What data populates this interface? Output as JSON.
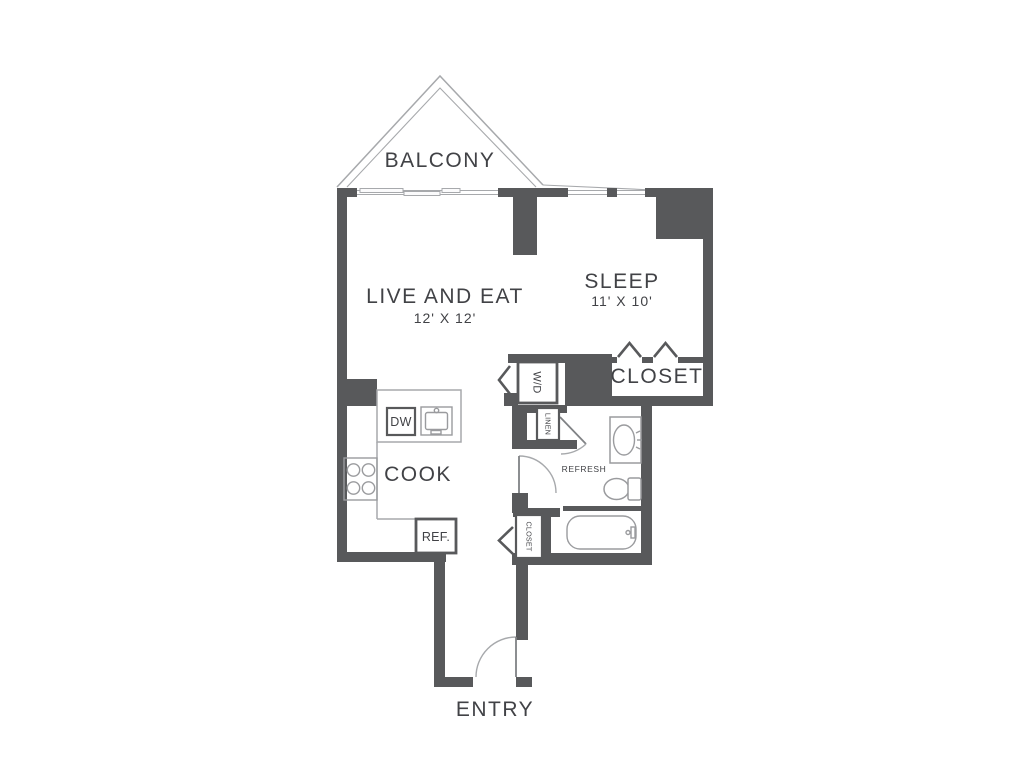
{
  "colors": {
    "wall": "#58595b",
    "line": "#a7a9ac",
    "line_mid": "#808285",
    "fixture": "#9a9b9e",
    "text": "#414246",
    "bg": "#ffffff"
  },
  "labels": {
    "balcony": "BALCONY",
    "live": "LIVE AND EAT",
    "live_dims": "12' X 12'",
    "sleep": "SLEEP",
    "sleep_dims": "11' X 10'",
    "closet": "CLOSET",
    "washer_dryer": "W/D",
    "linen": "LINEN",
    "refresh": "REFRESH",
    "entry_closet": "CLOSET",
    "cook": "COOK",
    "dishwasher": "DW",
    "refrigerator": "REF.",
    "entry": "ENTRY"
  }
}
